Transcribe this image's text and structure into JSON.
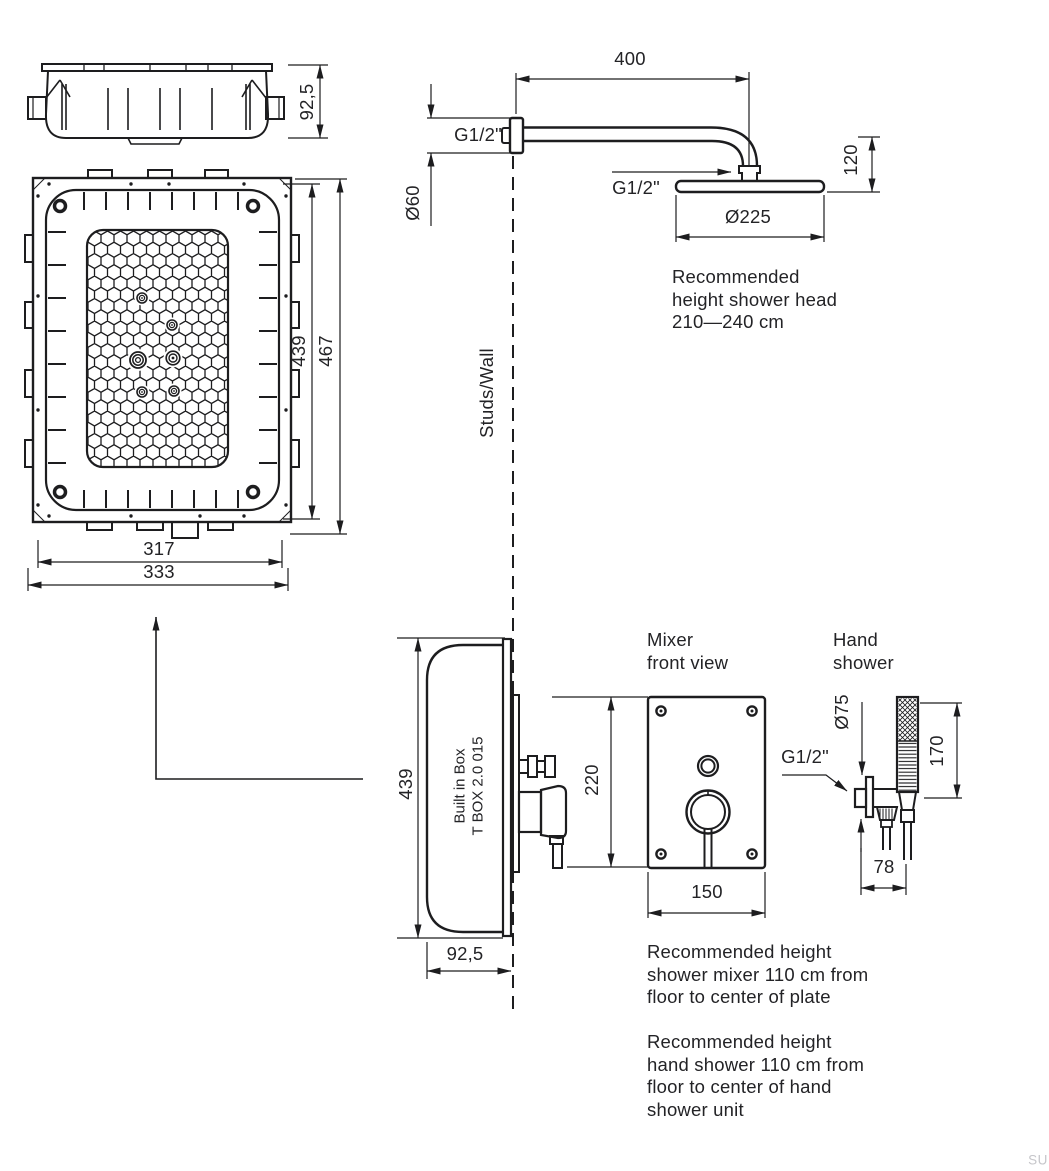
{
  "colors": {
    "line": "#1d1d1f",
    "text": "#232326",
    "watermark": "#c6c6ca"
  },
  "watermark": "SU",
  "labels": {
    "studs_wall": "Studs/Wall",
    "built_in_box": [
      "Built in Box",
      "T BOX 2.0 015"
    ],
    "mixer_title": [
      "Mixer",
      "front view"
    ],
    "hand_shower_title": [
      "Hand",
      "shower"
    ]
  },
  "dimensions": {
    "top_box_depth": "92,5",
    "front_inner_height": "439",
    "front_outer_height": "467",
    "front_inner_width": "317",
    "front_outer_width": "333",
    "arm_length": "400",
    "arm_thread": "G1/2\"",
    "arm_escutcheon_diameter": "Ø60",
    "head_thread": "G1/2\"",
    "head_diameter": "Ø225",
    "head_height": "120",
    "side_box_height": "439",
    "side_box_depth": "92,5",
    "mixer_plate_height": "220",
    "mixer_plate_width": "150",
    "hand_shower_thread": "G1/2\"",
    "hand_shower_escutcheon_diameter": "Ø75",
    "hand_shower_length": "170",
    "hand_shower_offset": "78"
  },
  "notes": {
    "shower_head_height": [
      "Recommended",
      "height shower head",
      "210—240 cm"
    ],
    "mixer_height": [
      "Recommended height",
      "shower mixer 110 cm from",
      "floor to center of plate"
    ],
    "hand_shower_height": [
      "Recommended height",
      "hand shower 110 cm from",
      "floor to center of hand",
      "shower unit"
    ]
  }
}
